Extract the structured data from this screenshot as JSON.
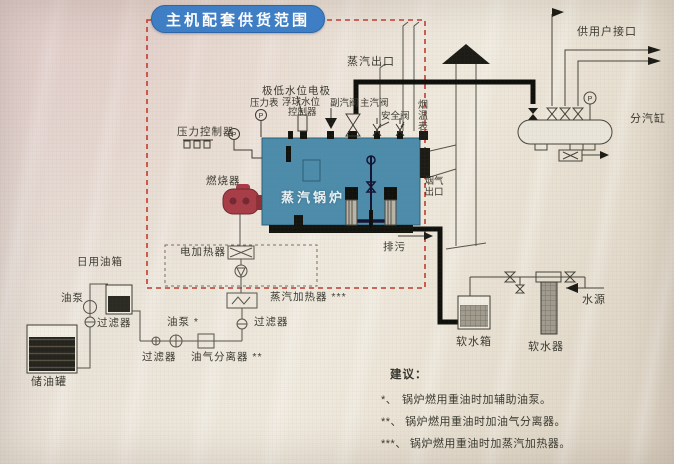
{
  "title": "主机配套供货范围",
  "labels": {
    "steam_outlet": "蒸汽出口",
    "user_port": "供用户接口",
    "steam_cylinder": "分汽缸",
    "low_water_electrode": "极低水位电极",
    "pressure_gauge": "压力表",
    "float_level_1": "浮球水位",
    "float_level_2": "控制器",
    "aux_steam_valve": "副汽阀",
    "main_steam_valve": "主汽阀",
    "safety_valve": "安全阀",
    "flue_temp_gauge": "烟温表",
    "pressure_controller": "压力控制器",
    "burner": "燃烧器",
    "boiler": "蒸汽锅炉",
    "flue_outlet_1": "烟气",
    "flue_outlet_2": "出口",
    "blowdown": "排污",
    "electric_heater": "电加热器",
    "steam_heater": "蒸汽加热器 ***",
    "daily_oil_tank": "日用油箱",
    "oil_pump_left": "油泵",
    "filter_left": "过滤器",
    "storage_tank": "储油罐",
    "oil_pump_mid": "油泵 *",
    "filter_mid": "过滤器",
    "filter_bottom": "过滤器",
    "oil_gas_separator": "油气分离器 **",
    "soft_water_tank": "软水箱",
    "water_softener": "软水器",
    "water_source": "水源",
    "gauge_p": "P"
  },
  "suggestions": {
    "title": "建议：",
    "items": [
      {
        "marker": "*、",
        "text": "锅炉燃用重油时加辅助油泵。"
      },
      {
        "marker": "**、",
        "text": "锅炉燃用重油时加油气分离器。"
      },
      {
        "marker": "***、",
        "text": "锅炉燃用重油时加蒸汽加热器。"
      }
    ]
  },
  "colors": {
    "background": "#e9e3d7",
    "boiler": "#4d8cab",
    "title_pill": "#3d7ec6",
    "burner": "#a83d47",
    "boundary_dashed": "#c23b2e",
    "line": "#55534a",
    "dark_fill": "#1c1b16"
  }
}
